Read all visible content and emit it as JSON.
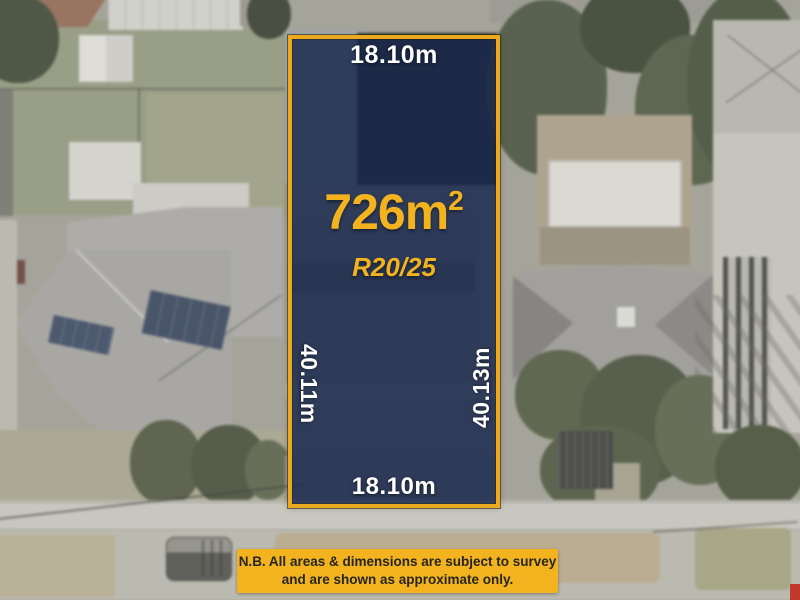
{
  "lot": {
    "dim_top": "18.10m",
    "dim_bottom": "18.10m",
    "dim_left": "40.11m",
    "dim_right": "40.13m",
    "area": "726m",
    "area_sup": "2",
    "zoning": "R20/25"
  },
  "disclaimer": {
    "line1": "N.B. All areas & dimensions are subject to survey",
    "line2": "and are shown as approximate only."
  },
  "colors": {
    "lot_fill": "#15244a",
    "lot_border": "#eaa91f",
    "dimension_text": "#ffffff",
    "area_text": "#f2b31f",
    "banner_bg": "#f2b31f",
    "banner_text": "#262522"
  }
}
